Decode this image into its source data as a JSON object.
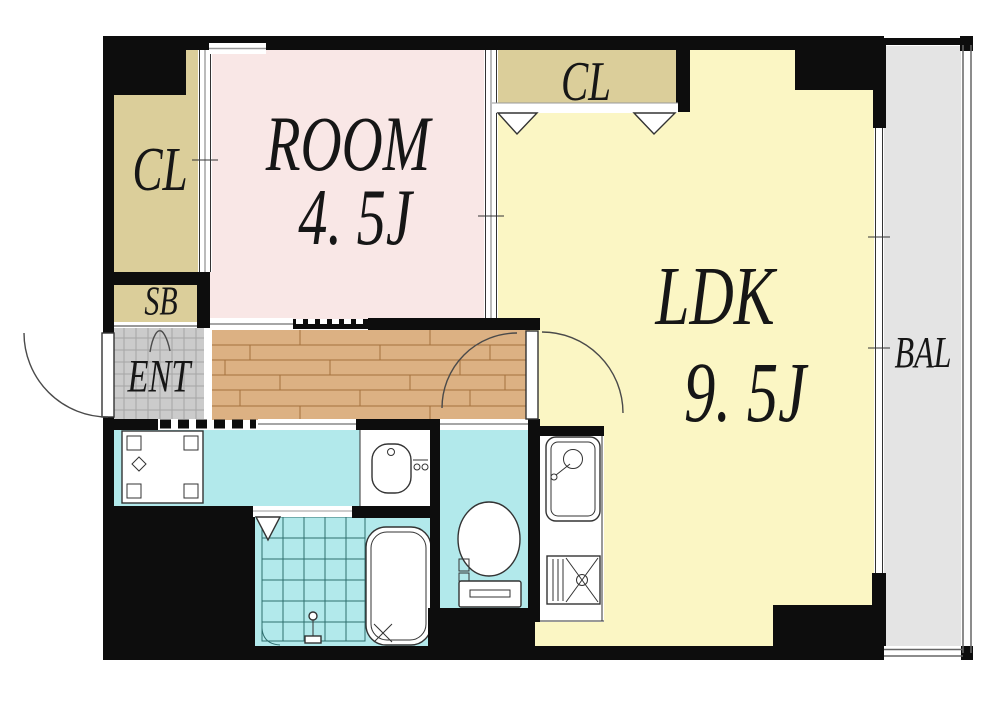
{
  "plan": {
    "title": "1LDK apartment floor plan",
    "rooms": {
      "closet_left": {
        "label": "CL"
      },
      "bedroom": {
        "label": "ROOM",
        "size": "4. 5J"
      },
      "closet_ldk": {
        "label": "CL"
      },
      "ldk": {
        "label": "LDK",
        "size": "9. 5J"
      },
      "shoe_box": {
        "label": "SB"
      },
      "entrance": {
        "label": "ENT"
      },
      "balcony": {
        "label": "BAL"
      }
    },
    "colors": {
      "room_pink": "#f9e7e6",
      "ldk_yellow": "#fbf6c4",
      "closet_tan": "#dbce9a",
      "wet_cyan": "#b2e9eb",
      "wood": "#dcb183",
      "wood_line": "#a5713d",
      "tile_gray": "#cbcbcb",
      "balcony_gray": "#e4e4e4",
      "wall_black": "#0d0d0d",
      "line_dark": "#333333"
    }
  }
}
